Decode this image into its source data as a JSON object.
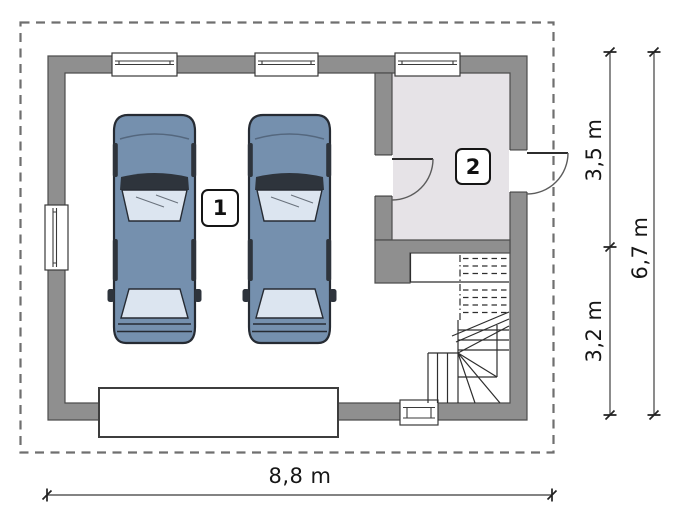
{
  "rooms": [
    {
      "id": "1",
      "type": "garage"
    },
    {
      "id": "2",
      "type": "utility-room"
    }
  ],
  "dimensions": {
    "bottom_width": "8,8 m",
    "right_upper": "3,5 m",
    "right_lower": "3,2 m",
    "right_total": "6,7 m"
  },
  "icons": [
    "car-icon",
    "stairs-icon",
    "window-symbol",
    "door-arc-symbol",
    "garage-door-symbol",
    "roof-outline-dashed"
  ],
  "colors": {
    "wall": "#8f8f8f",
    "wall_edge": "#4d4d4d",
    "room2_floor": "#e6e3e7",
    "line": "#2e2e2e",
    "roof_dash": "#6f6f6f",
    "dim_line": "#5a5a5a",
    "dim_tick": "#222222",
    "car_body": "#7590ae",
    "car_glass": "#dce5f0",
    "car_trim": "#2e343c"
  }
}
